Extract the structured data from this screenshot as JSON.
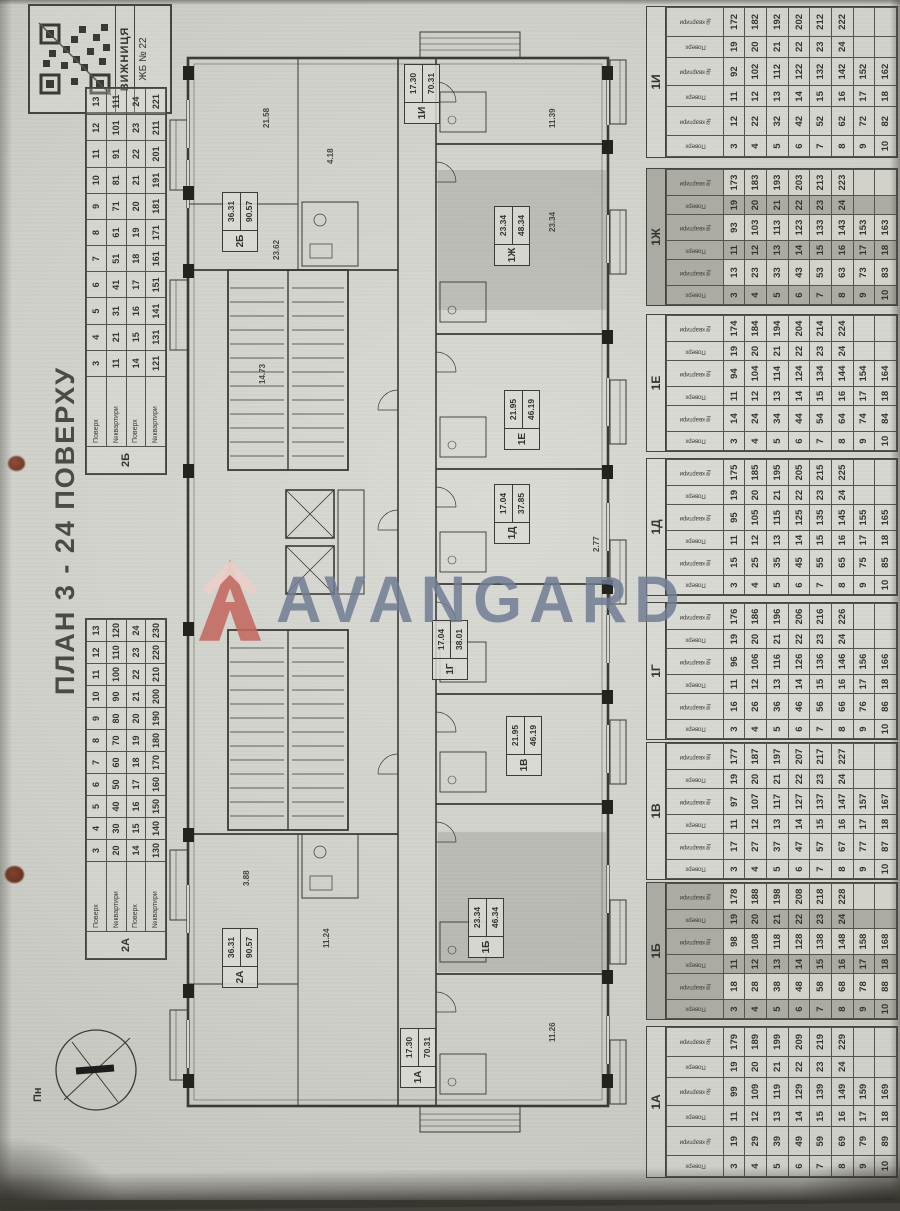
{
  "title": "ПЛАН 3 - 24 ПОВЕРХУ",
  "stamp": {
    "city": "ВИЖНИЦЯ",
    "building": "ЖБ № 22"
  },
  "compass": {
    "north_label": "Пн"
  },
  "watermark": {
    "brand": "AVANGARD",
    "logo_color": "#c4685f",
    "text_color": "#707c93"
  },
  "table_headers": {
    "floor": "Поверх",
    "apartment": "№квартири"
  },
  "left_tables": [
    {
      "label": "2Б",
      "rows": [
        [
          "3",
          "4",
          "5",
          "6",
          "7",
          "8",
          "9",
          "10",
          "11",
          "12",
          "13"
        ],
        [
          "11",
          "21",
          "31",
          "41",
          "51",
          "61",
          "71",
          "81",
          "91",
          "101",
          "111"
        ],
        [
          "14",
          "15",
          "16",
          "17",
          "18",
          "19",
          "20",
          "21",
          "22",
          "23",
          "24"
        ],
        [
          "121",
          "131",
          "141",
          "151",
          "161",
          "171",
          "181",
          "191",
          "201",
          "211",
          "221"
        ]
      ]
    },
    {
      "label": "2А",
      "rows": [
        [
          "3",
          "4",
          "5",
          "6",
          "7",
          "8",
          "9",
          "10",
          "11",
          "12",
          "13"
        ],
        [
          "20",
          "30",
          "40",
          "50",
          "60",
          "70",
          "80",
          "90",
          "100",
          "110",
          "120"
        ],
        [
          "14",
          "15",
          "16",
          "17",
          "18",
          "19",
          "20",
          "21",
          "22",
          "23",
          "24"
        ],
        [
          "130",
          "140",
          "150",
          "160",
          "170",
          "180",
          "190",
          "200",
          "210",
          "220",
          "230"
        ]
      ]
    }
  ],
  "right_tables": [
    {
      "label": "1И",
      "shaded": false,
      "rows": [
        [
          "3",
          "12",
          "11",
          "92",
          "19",
          "172"
        ],
        [
          "4",
          "22",
          "12",
          "102",
          "20",
          "182"
        ],
        [
          "5",
          "32",
          "13",
          "112",
          "21",
          "192"
        ],
        [
          "6",
          "42",
          "14",
          "122",
          "22",
          "202"
        ],
        [
          "7",
          "52",
          "15",
          "132",
          "23",
          "212"
        ],
        [
          "8",
          "62",
          "16",
          "142",
          "24",
          "222"
        ],
        [
          "9",
          "72",
          "17",
          "152",
          "",
          ""
        ],
        [
          "10",
          "82",
          "18",
          "162",
          "",
          ""
        ]
      ]
    },
    {
      "label": "1Ж",
      "shaded": true,
      "rows": [
        [
          "3",
          "13",
          "11",
          "93",
          "19",
          "173"
        ],
        [
          "4",
          "23",
          "12",
          "103",
          "20",
          "183"
        ],
        [
          "5",
          "33",
          "13",
          "113",
          "21",
          "193"
        ],
        [
          "6",
          "43",
          "14",
          "123",
          "22",
          "203"
        ],
        [
          "7",
          "53",
          "15",
          "133",
          "23",
          "213"
        ],
        [
          "8",
          "63",
          "16",
          "143",
          "24",
          "223"
        ],
        [
          "9",
          "73",
          "17",
          "153",
          "",
          ""
        ],
        [
          "10",
          "83",
          "18",
          "163",
          "",
          ""
        ]
      ]
    },
    {
      "label": "1Е",
      "shaded": false,
      "rows": [
        [
          "3",
          "14",
          "11",
          "94",
          "19",
          "174"
        ],
        [
          "4",
          "24",
          "12",
          "104",
          "20",
          "184"
        ],
        [
          "5",
          "34",
          "13",
          "114",
          "21",
          "194"
        ],
        [
          "6",
          "44",
          "14",
          "124",
          "22",
          "204"
        ],
        [
          "7",
          "54",
          "15",
          "134",
          "23",
          "214"
        ],
        [
          "8",
          "64",
          "16",
          "144",
          "24",
          "224"
        ],
        [
          "9",
          "74",
          "17",
          "154",
          "",
          ""
        ],
        [
          "10",
          "84",
          "18",
          "164",
          "",
          ""
        ]
      ]
    },
    {
      "label": "1Д",
      "shaded": false,
      "rows": [
        [
          "3",
          "15",
          "11",
          "95",
          "19",
          "175"
        ],
        [
          "4",
          "25",
          "12",
          "105",
          "20",
          "185"
        ],
        [
          "5",
          "35",
          "13",
          "115",
          "21",
          "195"
        ],
        [
          "6",
          "45",
          "14",
          "125",
          "22",
          "205"
        ],
        [
          "7",
          "55",
          "15",
          "135",
          "23",
          "215"
        ],
        [
          "8",
          "65",
          "16",
          "145",
          "24",
          "225"
        ],
        [
          "9",
          "75",
          "17",
          "155",
          "",
          ""
        ],
        [
          "10",
          "85",
          "18",
          "165",
          "",
          ""
        ]
      ]
    },
    {
      "label": "1Г",
      "shaded": false,
      "rows": [
        [
          "3",
          "16",
          "11",
          "96",
          "19",
          "176"
        ],
        [
          "4",
          "26",
          "12",
          "106",
          "20",
          "186"
        ],
        [
          "5",
          "36",
          "13",
          "116",
          "21",
          "196"
        ],
        [
          "6",
          "46",
          "14",
          "126",
          "22",
          "206"
        ],
        [
          "7",
          "56",
          "15",
          "136",
          "23",
          "216"
        ],
        [
          "8",
          "66",
          "16",
          "146",
          "24",
          "226"
        ],
        [
          "9",
          "76",
          "17",
          "156",
          "",
          ""
        ],
        [
          "10",
          "86",
          "18",
          "166",
          "",
          ""
        ]
      ]
    },
    {
      "label": "1В",
      "shaded": false,
      "rows": [
        [
          "3",
          "17",
          "11",
          "97",
          "19",
          "177"
        ],
        [
          "4",
          "27",
          "12",
          "107",
          "20",
          "187"
        ],
        [
          "5",
          "37",
          "13",
          "117",
          "21",
          "197"
        ],
        [
          "6",
          "47",
          "14",
          "127",
          "22",
          "207"
        ],
        [
          "7",
          "57",
          "15",
          "137",
          "23",
          "217"
        ],
        [
          "8",
          "67",
          "16",
          "147",
          "24",
          "227"
        ],
        [
          "9",
          "77",
          "17",
          "157",
          "",
          ""
        ],
        [
          "10",
          "87",
          "18",
          "167",
          "",
          ""
        ]
      ]
    },
    {
      "label": "1Б",
      "shaded": true,
      "rows": [
        [
          "3",
          "18",
          "11",
          "98",
          "19",
          "178"
        ],
        [
          "4",
          "28",
          "12",
          "108",
          "20",
          "188"
        ],
        [
          "5",
          "38",
          "13",
          "118",
          "21",
          "198"
        ],
        [
          "6",
          "48",
          "14",
          "128",
          "22",
          "208"
        ],
        [
          "7",
          "58",
          "15",
          "138",
          "23",
          "218"
        ],
        [
          "8",
          "68",
          "16",
          "148",
          "24",
          "228"
        ],
        [
          "9",
          "78",
          "17",
          "158",
          "",
          ""
        ],
        [
          "10",
          "88",
          "18",
          "168",
          "",
          ""
        ]
      ]
    },
    {
      "label": "1А",
      "shaded": false,
      "rows": [
        [
          "3",
          "19",
          "11",
          "99",
          "19",
          "179"
        ],
        [
          "4",
          "29",
          "12",
          "109",
          "20",
          "189"
        ],
        [
          "5",
          "39",
          "13",
          "119",
          "21",
          "199"
        ],
        [
          "6",
          "49",
          "14",
          "129",
          "22",
          "209"
        ],
        [
          "7",
          "59",
          "15",
          "139",
          "23",
          "219"
        ],
        [
          "8",
          "69",
          "16",
          "149",
          "24",
          "229"
        ],
        [
          "9",
          "79",
          "17",
          "159",
          "",
          ""
        ],
        [
          "10",
          "89",
          "18",
          "169",
          "",
          ""
        ]
      ]
    }
  ],
  "plan": {
    "units": [
      {
        "id": "2А",
        "area": "36.31",
        "total": "90.57"
      },
      {
        "id": "2Б",
        "area": "36.31",
        "total": "90.57"
      },
      {
        "id": "1А",
        "area": "17.30",
        "total": "70.31"
      },
      {
        "id": "1Б",
        "area": "23.34",
        "total": "46.34"
      },
      {
        "id": "1В",
        "area": "21.95",
        "total": "46.19"
      },
      {
        "id": "1Г",
        "area": "17.04",
        "total": "38.01"
      },
      {
        "id": "1Д",
        "area": "17.04",
        "total": "37.85"
      },
      {
        "id": "1Е",
        "area": "21.95",
        "total": "46.19"
      },
      {
        "id": "1Ж",
        "area": "23.34",
        "total": "48.34"
      },
      {
        "id": "1И",
        "area": "17.30",
        "total": "70.31"
      }
    ],
    "dims": [
      "21.58",
      "23.62",
      "14.73",
      "11.39",
      "4.18",
      "23.34",
      "2.77",
      "11.24",
      "3.88",
      "11.26"
    ]
  }
}
